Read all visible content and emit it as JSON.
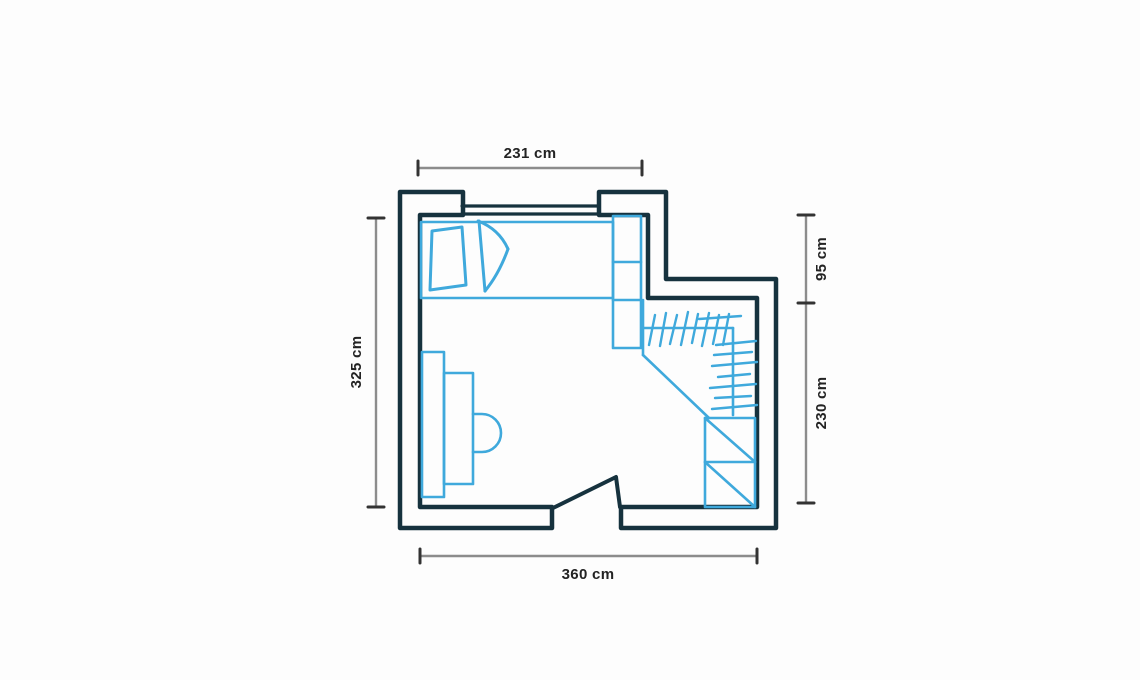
{
  "page": {
    "background_color": "#fdfdfd"
  },
  "floor_plan": {
    "style": "hand-drawn-sketch",
    "colors": {
      "wall": "#16323e",
      "furniture": "#3fa9dc",
      "dimension_line": "#8c8c8c",
      "tick": "#333333",
      "label_text": "#232323"
    },
    "dimensions": {
      "top": {
        "label": "231 cm",
        "orientation": "horizontal"
      },
      "left": {
        "label": "325 cm",
        "orientation": "vertical"
      },
      "right_upper": {
        "label": "95 cm",
        "orientation": "vertical"
      },
      "right_lower": {
        "label": "230 cm",
        "orientation": "vertical"
      },
      "bottom": {
        "label": "360 cm",
        "orientation": "horizontal"
      }
    },
    "features": [
      "exterior-walls",
      "window-top-wall",
      "door-bottom-wall",
      "bed",
      "pillow",
      "duvet",
      "shelf-column",
      "corner-wardrobe",
      "clothes-rail-hatching",
      "drawer-unit",
      "sideboard",
      "desk",
      "chair"
    ]
  }
}
